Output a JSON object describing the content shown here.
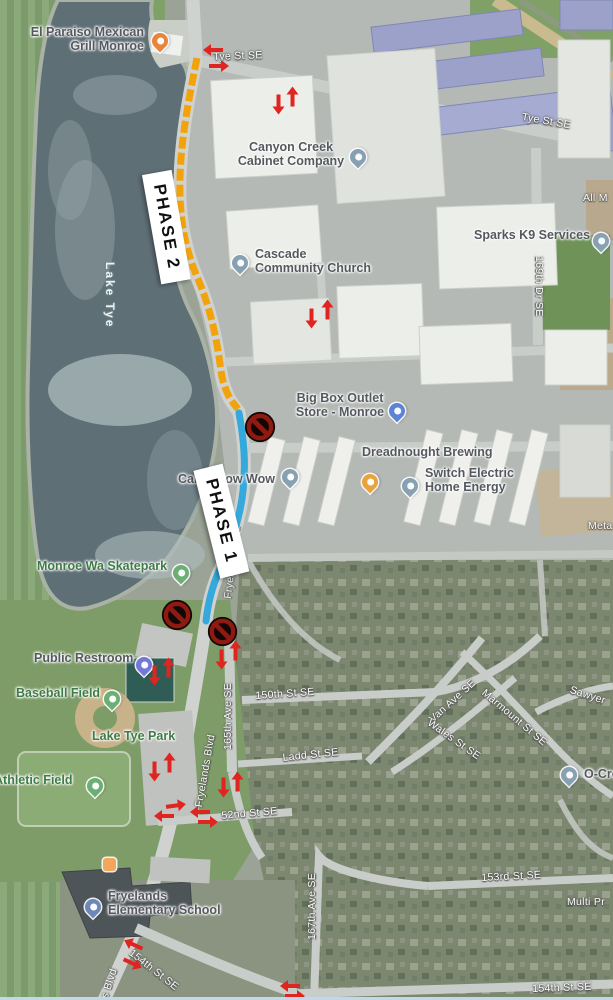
{
  "overlay": {
    "phase1_label": "PHASE 1",
    "phase2_label": "PHASE 2",
    "phase1_color": "#35A8DC",
    "phase2_color": "#F2A30B",
    "arrow_color": "#E02420",
    "no_entry_sign_color": "#8E1A12",
    "no_entry_sign_count": 3
  },
  "pois": {
    "el_paraiso": {
      "lines": [
        "El Paraiso Mexican",
        "Grill Monroe"
      ],
      "icon": "restaurant-pin",
      "pin_color": "#E8843B"
    },
    "canyon_creek": {
      "lines": [
        "Canyon Creek",
        "Cabinet Company"
      ],
      "icon": "business-pin",
      "pin_color": "#87A0B2"
    },
    "cascade_church": {
      "lines": [
        "Cascade",
        "Community Church"
      ],
      "icon": "church-pin",
      "pin_color": "#87A0B2"
    },
    "sparks_k9": {
      "label": "Sparks K9 Services",
      "icon": "business-pin",
      "pin_color": "#87A0B2"
    },
    "big_box": {
      "lines": [
        "Big Box Outlet",
        "Store - Monroe"
      ],
      "icon": "shopping-pin",
      "pin_color": "#5C84D6"
    },
    "dreadnought": {
      "label": "Dreadnought Brewing",
      "icon": "bar-pin",
      "pin_color": "#E8A33D"
    },
    "switch_electric": {
      "lines": [
        "Switch Electric",
        "Home Energy"
      ],
      "icon": "business-pin",
      "pin_color": "#87A0B2"
    },
    "camp_bow_wow": {
      "label": "Camp Bow Wow",
      "icon": "business-pin",
      "pin_color": "#87A0B2"
    },
    "skatepark": {
      "label": "Monroe Wa Skatepark",
      "icon": "park-pin",
      "pin_color": "#6BAF74"
    },
    "public_restroom": {
      "label": "Public Restroom",
      "icon": "restroom-pin",
      "pin_color": "#7577D6"
    },
    "baseball_field": {
      "label": "Baseball Field",
      "icon": "park-pin",
      "pin_color": "#6BAF74"
    },
    "lake_tye_park": {
      "label": "Lake Tye Park"
    },
    "athletic_field": {
      "label": "Athletic Field",
      "icon": "park-pin",
      "pin_color": "#6BAF74"
    },
    "fryelands_school": {
      "lines": [
        "Fryelands",
        "Elementary School"
      ],
      "icon": "school-pin",
      "pin_color": "#6E87B8"
    },
    "o_cre": {
      "label": "O-Cre",
      "icon": "business-pin",
      "pin_color": "#87A0B2"
    }
  },
  "streets": {
    "tye_st_top": "Tye St SE",
    "tye_st_right": "Tye St SE",
    "dr_169": "169th Dr SE",
    "st_150": "150th St SE",
    "ladd": "Ladd St SE",
    "st_52": "52nd St SE",
    "van_ave": "Van Ave SE",
    "wales": "Wales St SE",
    "marmount": "Marmount St SE",
    "sawyer": "Sawyer",
    "ave_165": "165th Ave SE",
    "fryelands_blvd": "Fryelands Blvd",
    "fryelands_blvd_2": "Fryelands Blvd",
    "ave_167": "167th Ave SE",
    "st_153": "153rd St SE",
    "st_154_upper": "154th St SE",
    "st_154_lower": "154th St SE",
    "blvd_partial": "s Blvd",
    "all_m": "All M",
    "meta": "Meta",
    "multi_pr": "Multi Pr"
  },
  "water": {
    "lake": "Lake Tye"
  }
}
